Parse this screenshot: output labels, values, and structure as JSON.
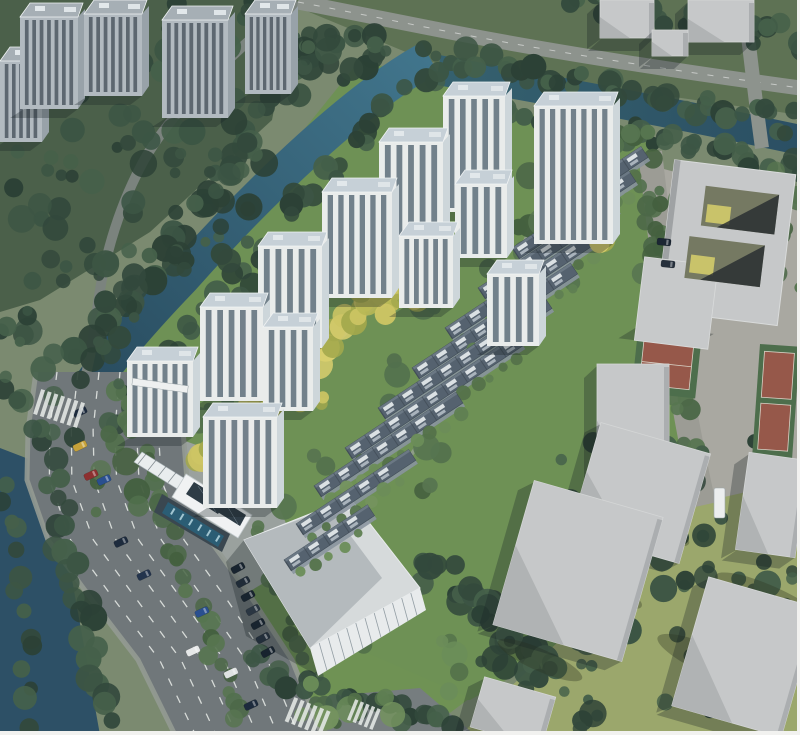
{
  "meta": {
    "description": "Aerial architectural rendering of a riverside residential development: white apartment towers and rows of dark-roofed townhouses inside a landscaped compound bounded by a canal, a wide arterial road, a clubhouse with swimming pool, a large flat-roofed commercial building, and gray context buildings with sports courts.",
    "width": 800,
    "height": 735
  },
  "palette": {
    "base": "#7b8a70",
    "forestFloor": "#4b604a",
    "topStrip": "#5e7254",
    "siteGrass": "#6e9155",
    "yellowGrass": "#9ba76c",
    "plaza": "#a9a8a1",
    "lawn": "#6f9254",
    "pavement": "#9aa19e",
    "waterLight": "#41758c",
    "waterDark": "#27495c",
    "river": "#2d5066",
    "roadMain": "#70777a",
    "roadSmall": "#7b837e",
    "roadTop": "#8d938d",
    "roadRight": "#9c9c95",
    "roadWedge": "#767d7f",
    "laneWhite": "#e9ece9",
    "towerFacade": "#e9eceb",
    "towerWin": "#5d6e7a",
    "towerRoof": "#c6d0d7",
    "towerSide": "#cdd6da",
    "ctxFacade": "#b2bac0",
    "ctxWin": "#4d5862",
    "ctxRoof": "#a6afb5",
    "ctxSide": "#98a2a9",
    "rowRoof": "#55626f",
    "rowEdge": "#424e59",
    "rowDeck": "#e7ebee",
    "rowFacade": "#8e99a3",
    "boxTop": "#c6c8c9",
    "boxShade": "#b0b3b4",
    "boxDark": "#9a9da0",
    "courtRed": "#96584a",
    "courtGreen": "#4d6e4c",
    "pool": "#2b5d74",
    "solar": "#2e3c46",
    "bigRoofLight": "#d6dadb",
    "bigRoofDark": "#b4babd",
    "bigFacade": "#e8ebec",
    "shadow": "rgba(22,32,38,0.3)",
    "treeDark": [
      "#33493c",
      "#3c5544",
      "#2c4136",
      "#45604a"
    ],
    "treeMid": [
      "#4c6848",
      "#577550",
      "#44603f",
      "#52704d"
    ],
    "treeLight": [
      "#5f7f52",
      "#6b8d59",
      "#54724a",
      "#74935e"
    ],
    "treeYellow": [
      "#b8b855",
      "#cdc564",
      "#a3a84c",
      "#d8ce6e"
    ]
  },
  "regions": [
    {
      "name": "forest-floor-top-left",
      "points": [
        [
          0,
          0
        ],
        [
          295,
          0
        ],
        [
          272,
          120
        ],
        [
          150,
          232
        ],
        [
          40,
          300
        ],
        [
          0,
          312
        ]
      ],
      "fill": "forestFloor"
    },
    {
      "name": "land-top-strip",
      "points": [
        [
          280,
          0
        ],
        [
          800,
          0
        ],
        [
          800,
          115
        ],
        [
          430,
          62
        ]
      ],
      "fill": "topStrip"
    },
    {
      "name": "site-lawn",
      "points": [
        [
          360,
          60
        ],
        [
          450,
          85
        ],
        [
          560,
          125
        ],
        [
          655,
          138
        ],
        [
          668,
          340
        ],
        [
          700,
          480
        ],
        [
          560,
          650
        ],
        [
          470,
          700
        ],
        [
          300,
          700
        ],
        [
          240,
          580
        ],
        [
          150,
          470
        ],
        [
          88,
          400
        ],
        [
          120,
          358
        ]
      ],
      "fill": "siteGrass"
    },
    {
      "name": "yellow-grass-southeast",
      "points": [
        [
          660,
          330
        ],
        [
          800,
          330
        ],
        [
          800,
          735
        ],
        [
          460,
          735
        ],
        [
          560,
          640
        ],
        [
          690,
          480
        ]
      ],
      "fill": "yellowGrass"
    },
    {
      "name": "plaza-east",
      "points": [
        [
          622,
          158
        ],
        [
          800,
          205
        ],
        [
          800,
          480
        ],
        [
          702,
          502
        ],
        [
          666,
          330
        ],
        [
          648,
          158
        ]
      ],
      "fill": "plaza"
    },
    {
      "name": "entrance-pavement",
      "points": [
        [
          148,
          428
        ],
        [
          262,
          468
        ],
        [
          302,
          560
        ],
        [
          232,
          602
        ],
        [
          178,
          520
        ]
      ],
      "fill": "pavement"
    },
    {
      "name": "front-lawn",
      "points": [
        [
          288,
          618
        ],
        [
          470,
          698
        ],
        [
          420,
          735
        ],
        [
          298,
          720
        ]
      ],
      "fill": "lawn"
    }
  ],
  "water": {
    "nw_canal": "M430,58 C360,95 262,188 182,278 C132,330 97,372 72,415",
    "north_canal": "M438,70 C560,92 680,114 800,140",
    "river": [
      [
        0,
        448
      ],
      [
        52,
        468
      ],
      [
        100,
        735
      ],
      [
        0,
        735
      ]
    ]
  },
  "site_paths": [
    "M560,142 C540,210 510,280 480,340 C455,390 430,430 400,470",
    "M200,465 C280,395 360,320 440,245",
    "M150,430 C210,480 260,530 300,585"
  ],
  "roads": {
    "forest_road": "M252,38 C205,80 165,122 143,162 C120,205 104,255 97,310 C93,345 88,368 80,398",
    "forest_link": "M298,2 C280,14 265,26 252,38",
    "top_road": "M298,2 C340,10 380,18 430,28 C520,46 640,66 800,88",
    "vertical_road": "M748,36 C752,70 756,105 762,148",
    "right_road": "M650,152 C658,220 666,290 676,355 C684,410 694,460 704,505",
    "bottom_wedge": [
      [
        308,
        698
      ],
      [
        420,
        688
      ],
      [
        475,
        735
      ],
      [
        330,
        735
      ]
    ]
  },
  "main_road": {
    "stations": [
      [
        372,
        36,
        186
      ],
      [
        430,
        28,
        183
      ],
      [
        480,
        27,
        187
      ],
      [
        540,
        48,
        210
      ],
      [
        600,
        92,
        253
      ],
      [
        660,
        138,
        292
      ],
      [
        735,
        175,
        322
      ]
    ],
    "lane_fractions": [
      0.14,
      0.28,
      0.42,
      0.56,
      0.7,
      0.84
    ]
  },
  "towers": [
    [
      443,
      82,
      62,
      130
    ],
    [
      534,
      92,
      79,
      152
    ],
    [
      379,
      128,
      64,
      118
    ],
    [
      322,
      178,
      70,
      120
    ],
    [
      455,
      170,
      52,
      88
    ],
    [
      399,
      222,
      54,
      86
    ],
    [
      487,
      260,
      52,
      86
    ],
    [
      258,
      232,
      64,
      116
    ],
    [
      200,
      293,
      63,
      108
    ],
    [
      263,
      313,
      50,
      98
    ],
    [
      127,
      347,
      66,
      90
    ],
    [
      203,
      403,
      74,
      105
    ]
  ],
  "context_towers": [
    [
      0,
      47,
      42,
      95
    ],
    [
      20,
      3,
      58,
      106
    ],
    [
      84,
      0,
      58,
      96
    ],
    [
      162,
      6,
      66,
      112
    ],
    [
      245,
      0,
      46,
      94
    ]
  ],
  "townhouse_rows": [
    [
      545,
      210,
      115
    ],
    [
      512,
      248,
      140
    ],
    [
      478,
      288,
      160
    ],
    [
      445,
      328,
      178
    ],
    [
      412,
      368,
      190
    ],
    [
      378,
      408,
      200
    ],
    [
      345,
      448,
      205
    ],
    [
      314,
      486,
      170
    ],
    [
      296,
      524,
      135
    ],
    [
      284,
      560,
      100
    ]
  ],
  "gray_boxes": [
    [
      600,
      0,
      54,
      38,
      0
    ],
    [
      688,
      0,
      66,
      42,
      0
    ],
    [
      652,
      30,
      36,
      26,
      0
    ],
    [
      597,
      364,
      72,
      126,
      0
    ],
    [
      583,
      436,
      114,
      114,
      16
    ],
    [
      511,
      496,
      134,
      150,
      16
    ],
    [
      688,
      590,
      114,
      134,
      16
    ],
    [
      742,
      456,
      60,
      98,
      8
    ],
    [
      476,
      686,
      74,
      52,
      16
    ]
  ],
  "courtyard_complex": {
    "rotation": 7,
    "slab": [
      664,
      166,
      122,
      152
    ],
    "wing": [
      646,
      266,
      74,
      84
    ],
    "courtyards": [
      [
        698,
        188,
        74,
        40
      ],
      [
        688,
        240,
        76,
        42
      ]
    ]
  },
  "courts": {
    "main": {
      "rotation": 6,
      "green": [
        638,
        330,
        64,
        62
      ],
      "red": [
        645,
        338,
        50,
        46
      ]
    },
    "edge": {
      "rotation": 4,
      "green": [
        760,
        344,
        40,
        112
      ],
      "reds": [
        [
          765,
          351,
          30,
          46
        ],
        [
          765,
          403,
          30,
          46
        ]
      ]
    }
  },
  "big_building": {
    "roof": [
      [
        244,
        540
      ],
      [
        350,
        498
      ],
      [
        420,
        588
      ],
      [
        310,
        648
      ]
    ],
    "roof_shadow": [
      [
        244,
        540
      ],
      [
        330,
        508
      ],
      [
        382,
        578
      ],
      [
        310,
        648
      ]
    ],
    "facade": [
      [
        310,
        648
      ],
      [
        420,
        588
      ],
      [
        426,
        610
      ],
      [
        318,
        676
      ]
    ],
    "ground_shadow": [
      [
        244,
        540
      ],
      [
        310,
        648
      ],
      [
        318,
        676
      ],
      [
        246,
        636
      ],
      [
        226,
        562
      ]
    ]
  },
  "clubhouse": {
    "canopy": [
      [
        142,
        452
      ],
      [
        232,
        508
      ],
      [
        224,
        518
      ],
      [
        134,
        462
      ]
    ],
    "deck": [
      [
        162,
        494
      ],
      [
        230,
        534
      ],
      [
        222,
        552
      ],
      [
        154,
        512
      ]
    ],
    "roof": [
      [
        186,
        474
      ],
      [
        252,
        515
      ],
      [
        238,
        538
      ],
      [
        172,
        497
      ]
    ],
    "solar_panels": [
      [
        [
          194,
          482
        ],
        [
          226,
          502
        ],
        [
          218,
          514
        ],
        [
          186,
          494
        ]
      ],
      [
        [
          222,
          500
        ],
        [
          246,
          515
        ],
        [
          240,
          526
        ],
        [
          216,
          511
        ]
      ]
    ],
    "pool": [
      [
        168,
        502
      ],
      [
        224,
        536
      ],
      [
        218,
        547
      ],
      [
        162,
        513
      ]
    ]
  },
  "gate": {
    "bar": [
      132,
      382,
      56,
      7
    ],
    "rotation": 8
  },
  "tree_belts": [
    [
      330,
      30,
      70,
      380,
      46,
      8,
      15,
      "treeDark",
      14
    ],
    [
      400,
      95,
      110,
      430,
      40,
      7,
      13,
      "treeDark",
      12
    ],
    [
      440,
      55,
      800,
      125,
      42,
      7,
      13,
      "treeDark",
      12
    ],
    [
      455,
      100,
      800,
      168,
      40,
      7,
      12,
      "treeDark",
      10
    ],
    [
      45,
      450,
      108,
      728,
      26,
      8,
      14,
      "treeDark",
      12
    ],
    [
      0,
      470,
      40,
      735,
      14,
      7,
      12,
      "treeDark",
      10
    ],
    [
      118,
      390,
      240,
      730,
      30,
      6,
      11,
      "treeMid",
      9
    ],
    [
      208,
      402,
      332,
      730,
      26,
      5,
      9,
      "treeMid",
      8
    ],
    [
      645,
      160,
      695,
      480,
      30,
      6,
      11,
      "treeMid",
      10
    ],
    [
      420,
      560,
      560,
      690,
      30,
      8,
      14,
      "treeDark",
      18
    ],
    [
      240,
      660,
      460,
      735,
      26,
      7,
      12,
      "treeDark",
      12
    ],
    [
      560,
      0,
      800,
      40,
      30,
      7,
      12,
      "treeDark",
      14
    ],
    [
      240,
      0,
      320,
      60,
      12,
      6,
      11,
      "treeDark",
      10
    ],
    [
      548,
      148,
      652,
      136,
      14,
      6,
      10,
      "treeMid",
      8
    ]
  ],
  "tree_patches": [
    [
      0,
      0,
      270,
      270,
      90,
      "treeDark"
    ],
    [
      300,
      30,
      140,
      60,
      22,
      "treeDark"
    ],
    [
      560,
      430,
      240,
      290,
      40,
      "treeDark"
    ],
    [
      640,
      180,
      60,
      140,
      16,
      "treeMid"
    ],
    [
      760,
      170,
      40,
      120,
      10,
      "treeMid"
    ],
    [
      90,
      250,
      80,
      140,
      18,
      "treeDark"
    ],
    [
      0,
      280,
      90,
      160,
      20,
      "treeDark"
    ],
    [
      150,
      300,
      300,
      220,
      26,
      "treeMid"
    ],
    [
      360,
      150,
      220,
      160,
      20,
      "treeMid"
    ],
    [
      480,
      640,
      120,
      95,
      18,
      "treeDark"
    ],
    [
      680,
      480,
      120,
      110,
      14,
      "treeDark"
    ],
    [
      300,
      640,
      160,
      80,
      16,
      "treeLight"
    ],
    [
      95,
      430,
      45,
      90,
      8,
      "treeMid"
    ]
  ],
  "yellow_belts": [
    [
      198,
      468,
      325,
      342,
      26,
      9,
      15,
      "treeYellow",
      9
    ],
    [
      325,
      342,
      435,
      240,
      20,
      8,
      13,
      "treeYellow",
      8
    ]
  ],
  "yellow_patches": [
    [
      360,
      290,
      40,
      28,
      6,
      "treeYellow"
    ],
    [
      405,
      282,
      36,
      24,
      5,
      "treeYellow"
    ],
    [
      565,
      196,
      34,
      24,
      5,
      "treeYellow"
    ],
    [
      590,
      225,
      30,
      22,
      4,
      "treeYellow"
    ],
    [
      245,
      325,
      30,
      22,
      4,
      "treeYellow"
    ],
    [
      298,
      385,
      26,
      20,
      4,
      "treeYellow"
    ]
  ],
  "shadow_streaks": [
    [
      636,
      520,
      58,
      13
    ],
    [
      718,
      664,
      66,
      15
    ],
    [
      596,
      586,
      50,
      12
    ],
    [
      770,
      600,
      60,
      14
    ],
    [
      540,
      660,
      46,
      11
    ]
  ],
  "cars": [
    [
      80,
      412,
      65,
      "#1d2b3d"
    ],
    [
      80,
      446,
      65,
      "#c7a23a"
    ],
    [
      91,
      475,
      65,
      "#8d3030"
    ],
    [
      104,
      480,
      65,
      "#2a4f8f"
    ],
    [
      121,
      542,
      65,
      "#1d2b3d"
    ],
    [
      144,
      575,
      65,
      "#23344d"
    ],
    [
      202,
      612,
      65,
      "#2a4f8f"
    ],
    [
      193,
      651,
      65,
      "#e6e8e8"
    ],
    [
      231,
      673,
      65,
      "#dfe2e2"
    ],
    [
      251,
      705,
      65,
      "#1d2b3d"
    ],
    [
      664,
      242,
      96,
      "#1b2633"
    ],
    [
      668,
      264,
      96,
      "#26303c"
    ]
  ],
  "parked_cars": [
    [
      238,
      568,
      62,
      "#18242f"
    ],
    [
      243,
      582,
      62,
      "#202c38"
    ],
    [
      248,
      596,
      62,
      "#18242f"
    ],
    [
      253,
      610,
      62,
      "#2a3642"
    ],
    [
      258,
      624,
      62,
      "#18242f"
    ],
    [
      263,
      638,
      62,
      "#222e3a"
    ],
    [
      268,
      652,
      62,
      "#18242f"
    ]
  ],
  "bus": [
    714,
    488,
    11,
    30
  ],
  "crosswalks": [
    [
      36,
      396,
      18,
      7,
      4,
      26,
      7
    ],
    [
      288,
      704,
      22,
      6,
      4,
      26,
      7
    ],
    [
      350,
      704,
      22,
      5,
      3.5,
      22,
      6
    ]
  ]
}
